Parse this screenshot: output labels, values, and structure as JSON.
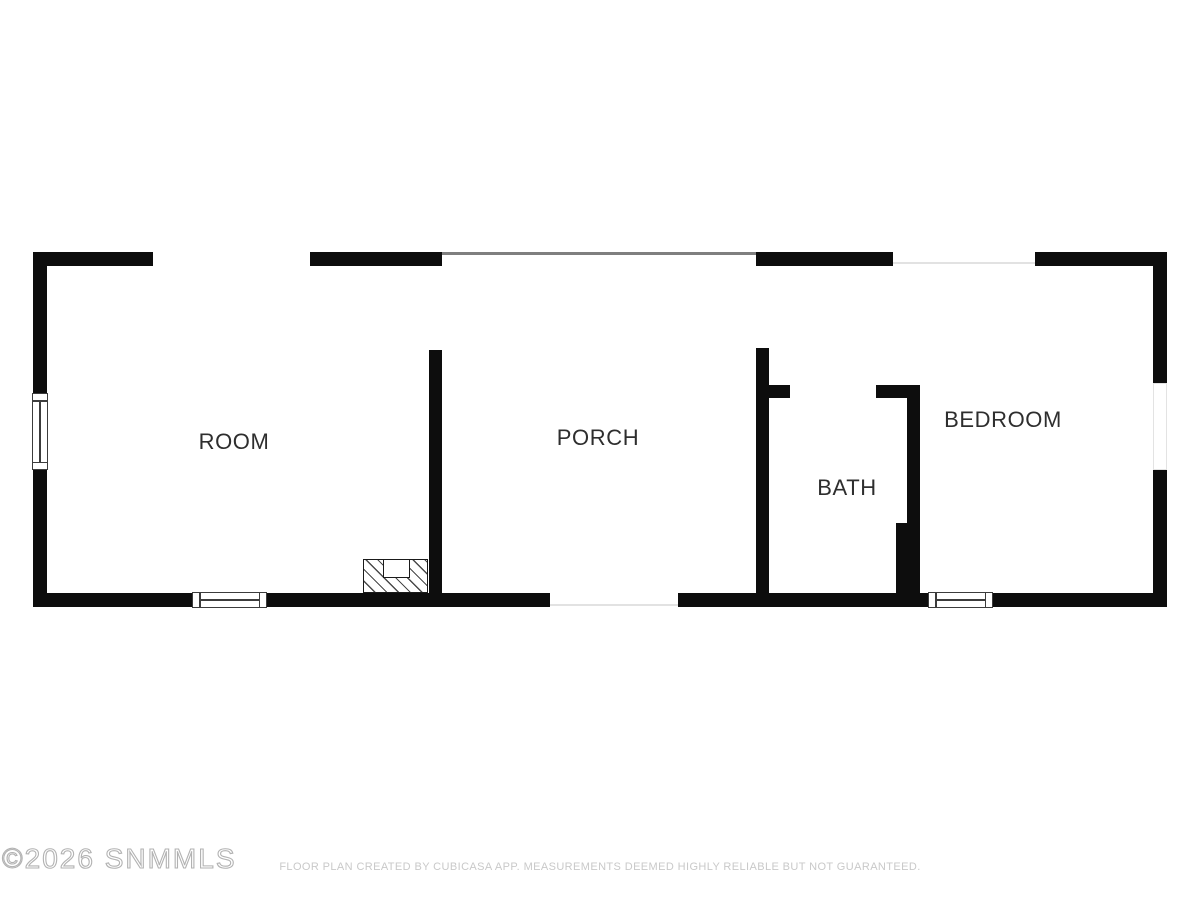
{
  "watermark": {
    "text": "©2026 SNMMLS"
  },
  "footer": {
    "disclaimer": "FLOOR PLAN CREATED BY CUBICASA APP. MEASUREMENTS DEEMED HIGHLY RELIABLE BUT NOT GUARANTEED."
  },
  "rooms": {
    "room": {
      "label": "ROOM"
    },
    "porch": {
      "label": "PORCH"
    },
    "bath": {
      "label": "BATH"
    },
    "bedroom": {
      "label": "BEDROOM"
    }
  },
  "colors": {
    "wall": "#0d0d0d",
    "room_label": "#2e2e2e",
    "porch_edge_line": "#7f7f7f",
    "opening_line": "#e2e2e2",
    "watermark": "#b2b2b2",
    "footer_text": "#c9c9c9",
    "background": "#ffffff"
  },
  "plan": {
    "walls": [
      {
        "name": "room-top-wall-left",
        "x": 33,
        "y": 252,
        "w": 120,
        "h": 14
      },
      {
        "name": "room-top-wall-right",
        "x": 310,
        "y": 252,
        "w": 132,
        "h": 14
      },
      {
        "name": "bedroom-top-wall-left",
        "x": 756,
        "y": 252,
        "w": 137,
        "h": 14
      },
      {
        "name": "bedroom-top-wall-right",
        "x": 1035,
        "y": 252,
        "w": 132,
        "h": 14
      },
      {
        "name": "room-left-wall-upper",
        "x": 33,
        "y": 266,
        "w": 14,
        "h": 127
      },
      {
        "name": "room-left-wall-lower",
        "x": 33,
        "y": 470,
        "w": 14,
        "h": 137
      },
      {
        "name": "bottom-wall-room-left",
        "x": 33,
        "y": 593,
        "w": 159,
        "h": 14
      },
      {
        "name": "bottom-wall-room-right",
        "x": 267,
        "y": 593,
        "w": 283,
        "h": 14
      },
      {
        "name": "bottom-wall-bath",
        "x": 678,
        "y": 593,
        "w": 250,
        "h": 14
      },
      {
        "name": "bottom-wall-bedroom",
        "x": 993,
        "y": 593,
        "w": 174,
        "h": 14
      },
      {
        "name": "bedroom-right-wall-upper",
        "x": 1153,
        "y": 266,
        "w": 14,
        "h": 117
      },
      {
        "name": "bedroom-right-wall-lower",
        "x": 1153,
        "y": 470,
        "w": 14,
        "h": 137
      },
      {
        "name": "porch-left-wall",
        "x": 429,
        "y": 350,
        "w": 13,
        "h": 243
      },
      {
        "name": "porch-right-wall",
        "x": 756,
        "y": 348,
        "w": 13,
        "h": 245
      },
      {
        "name": "bath-top-wall-left-stub",
        "x": 769,
        "y": 385,
        "w": 21,
        "h": 13
      },
      {
        "name": "bath-top-wall-right",
        "x": 876,
        "y": 385,
        "w": 44,
        "h": 13
      },
      {
        "name": "bath-right-wall-upper",
        "x": 907,
        "y": 398,
        "w": 13,
        "h": 125
      },
      {
        "name": "bath-right-wall-lower",
        "x": 896,
        "y": 523,
        "w": 24,
        "h": 70
      }
    ],
    "porch_edge": {
      "name": "porch-top-edge-line",
      "x": 442,
      "y": 252,
      "w": 314,
      "h": 2.5
    },
    "opening_lines": [
      {
        "name": "bedroom-top-opening-line",
        "x": 893,
        "y": 262,
        "w": 142,
        "h": 2
      },
      {
        "name": "porch-bottom-opening-line",
        "x": 550,
        "y": 604,
        "w": 128,
        "h": 2
      }
    ],
    "right_wall_opening": {
      "name": "bedroom-right-wall-opening",
      "x": 1153,
      "y": 383,
      "w": 14,
      "h": 87
    },
    "windows": [
      {
        "name": "room-left-window",
        "orient": "v",
        "x": 32,
        "y": 393,
        "w": 16,
        "h": 77
      },
      {
        "name": "room-bottom-window",
        "orient": "h",
        "x": 192,
        "y": 592,
        "w": 75,
        "h": 16
      },
      {
        "name": "bedroom-bottom-window",
        "orient": "h",
        "x": 928,
        "y": 592,
        "w": 65,
        "h": 16
      }
    ],
    "fireplace": {
      "box": {
        "x": 363,
        "y": 559,
        "w": 65,
        "h": 34
      },
      "notch": {
        "x": 383,
        "y": 559,
        "w": 27,
        "h": 19
      }
    }
  }
}
